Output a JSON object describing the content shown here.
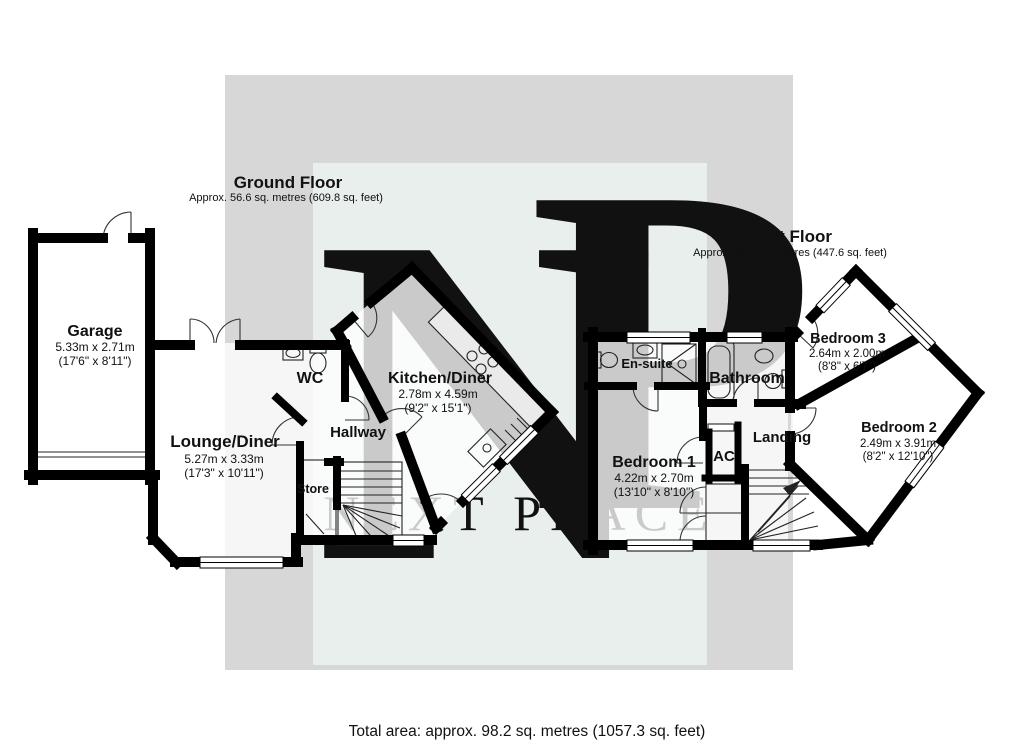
{
  "watermark": {
    "monogram_n": "N",
    "monogram_p": "P",
    "brand": "NEXT PLACE"
  },
  "floors": {
    "ground": {
      "title": "Ground Floor",
      "area": "Approx. 56.6 sq. metres (609.8 sq. feet)"
    },
    "first": {
      "title": "First Floor",
      "area": "Approx. 41.6 sq. metres (447.6 sq. feet)"
    }
  },
  "rooms": {
    "garage": {
      "name": "Garage",
      "metric": "5.33m x 2.71m",
      "imperial": "(17'6\" x 8'11\")"
    },
    "lounge": {
      "name": "Lounge/Diner",
      "metric": "5.27m x 3.33m",
      "imperial": "(17'3\" x 10'11\")"
    },
    "wc": {
      "name": "WC"
    },
    "hallway": {
      "name": "Hallway"
    },
    "store": {
      "name": "Store"
    },
    "kitchen": {
      "name": "Kitchen/Diner",
      "metric": "2.78m x 4.59m",
      "imperial": "(9'2\" x 15'1\")"
    },
    "ensuite": {
      "name": "En-suite"
    },
    "bathroom": {
      "name": "Bathroom"
    },
    "bedroom1": {
      "name": "Bedroom 1",
      "metric": "4.22m x 2.70m",
      "imperial": "(13'10\" x 8'10\")"
    },
    "ac": {
      "name": "AC"
    },
    "landing": {
      "name": "Landing"
    },
    "bedroom3": {
      "name": "Bedroom 3",
      "metric": "2.64m x 2.00m",
      "imperial": "(8'8\" x 6'7\")"
    },
    "bedroom2": {
      "name": "Bedroom 2",
      "metric": "2.49m x 3.91m",
      "imperial": "(8'2\" x 12'10\")"
    }
  },
  "footer": {
    "total_area": "Total area: approx. 98.2 sq. metres (1057.3 sq. feet)"
  },
  "colors": {
    "wall": "#000000",
    "watermark_gray": "#d7d7d8",
    "plan_tint": "#e9efec",
    "room_fill": "rgba(255,255,255,0.78)"
  }
}
